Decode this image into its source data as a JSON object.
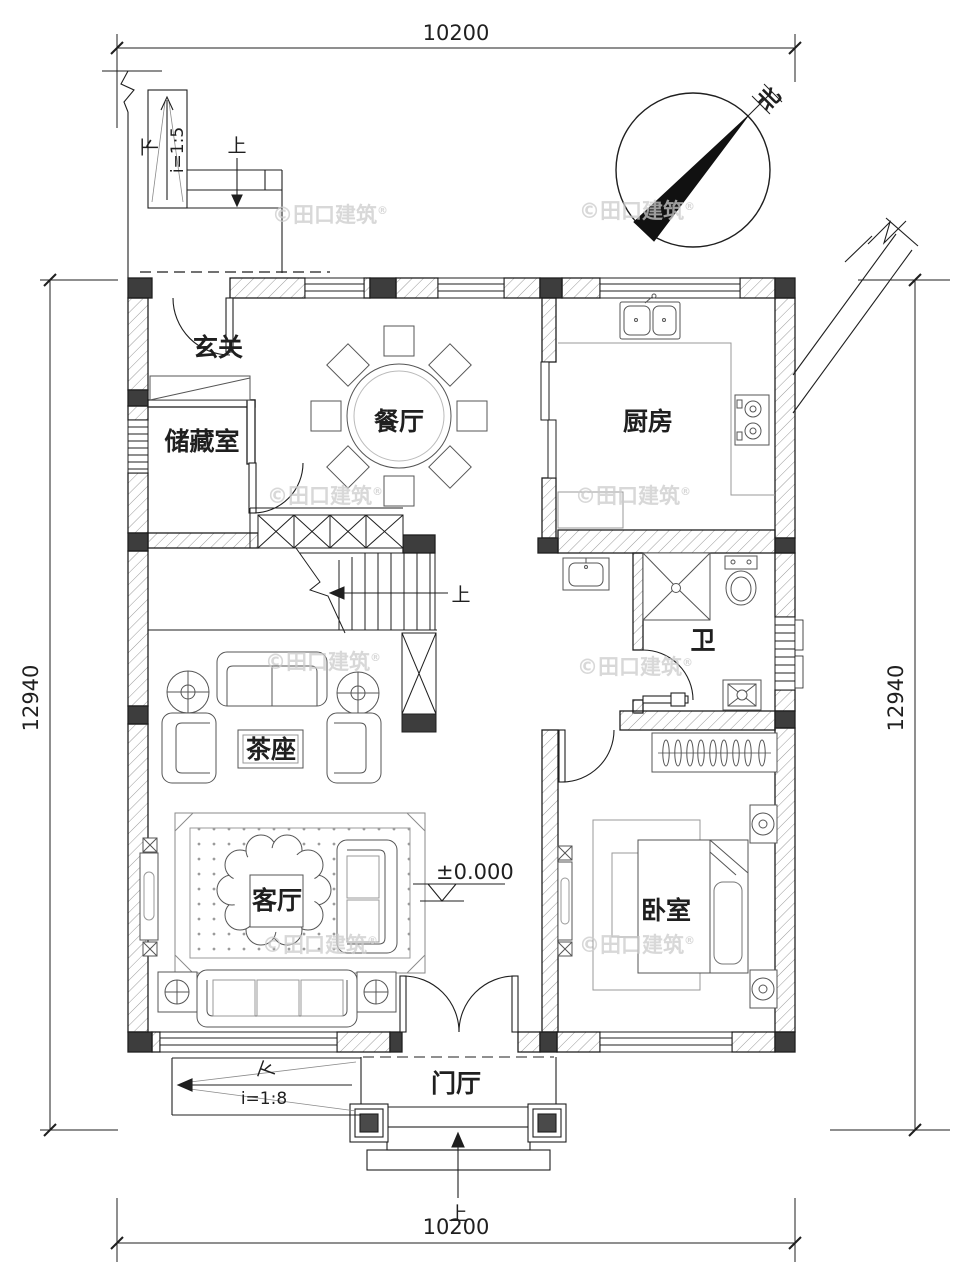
{
  "dimensions": {
    "top": "10200",
    "bottom": "10200",
    "left": "12940",
    "right": "12940"
  },
  "rooms": {
    "entry": "玄关",
    "storage": "储藏室",
    "dining": "餐厅",
    "kitchen": "厨房",
    "bath": "卫",
    "tea_table": "茶座",
    "living": "客厅",
    "bedroom": "卧室",
    "hall": "门厅"
  },
  "marks": {
    "elevation": "±0.000",
    "slope_entry_ramp": "i=1:5",
    "slope_porch_ramp": "i=1:8",
    "up": "上",
    "down": "下",
    "north": "北"
  },
  "watermark": {
    "text": "©田口建筑",
    "registered": "®"
  },
  "colors": {
    "line": "#1f1f1f",
    "dark_fill": "#3d3d3d",
    "hatch_line": "#9a9a9a",
    "furniture_line": "#555555",
    "watermark": "#cccccc",
    "background": "#ffffff"
  }
}
